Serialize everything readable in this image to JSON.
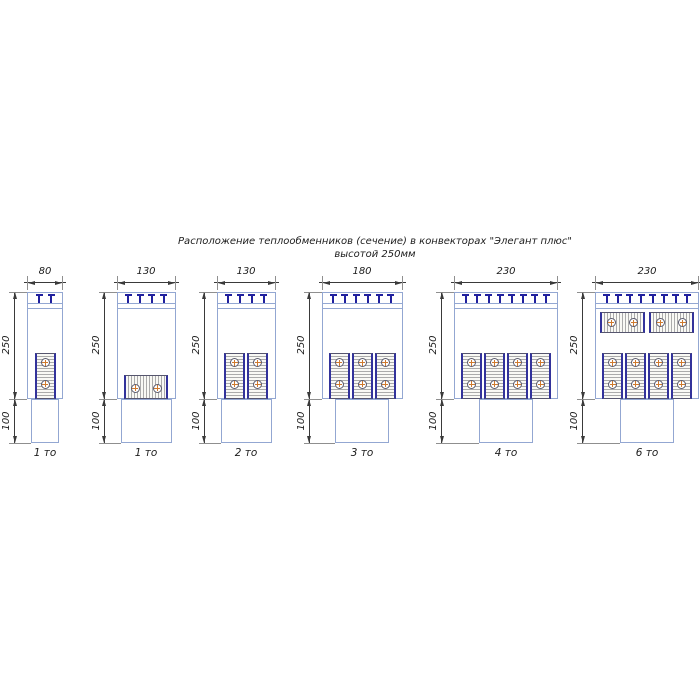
{
  "title": {
    "line1": "Расположение теплообменников (сечение) в конвекторах \"Элегант плюс\"",
    "line2": "высотой 250мм"
  },
  "diagram": {
    "body_height_label": "250",
    "duct_height_label": "100",
    "colors": {
      "outline": "#93a7d2",
      "bracket": "#20209e",
      "dim": "#3a3a3a",
      "ext": "#8f8f8f",
      "block_side": "#32329b",
      "block_border": "#56566e",
      "tube_ring": "#5c5c6e",
      "tube_cross": "#cf7a2e",
      "text": "#1d1d1d"
    },
    "figures": [
      {
        "width_label": "80",
        "type_label": "1 то",
        "brackets": 2,
        "exchangers": {
          "bottom": {
            "orientation": "vertical",
            "count": 1
          }
        }
      },
      {
        "width_label": "130",
        "type_label": "1 то",
        "brackets": 4,
        "exchangers": {
          "bottom": {
            "orientation": "horizontal",
            "count": 1
          }
        }
      },
      {
        "width_label": "130",
        "type_label": "2 то",
        "brackets": 4,
        "exchangers": {
          "bottom": {
            "orientation": "vertical",
            "count": 2
          }
        }
      },
      {
        "width_label": "180",
        "type_label": "3 то",
        "brackets": 6,
        "exchangers": {
          "bottom": {
            "orientation": "vertical",
            "count": 3
          }
        }
      },
      {
        "width_label": "230",
        "type_label": "4 то",
        "brackets": 8,
        "exchangers": {
          "bottom": {
            "orientation": "vertical",
            "count": 4
          }
        }
      },
      {
        "width_label": "230",
        "type_label": "6 то",
        "brackets": 8,
        "exchangers": {
          "bottom": {
            "orientation": "vertical",
            "count": 4
          },
          "top": {
            "orientation": "horizontal",
            "count": 2
          }
        }
      }
    ]
  }
}
